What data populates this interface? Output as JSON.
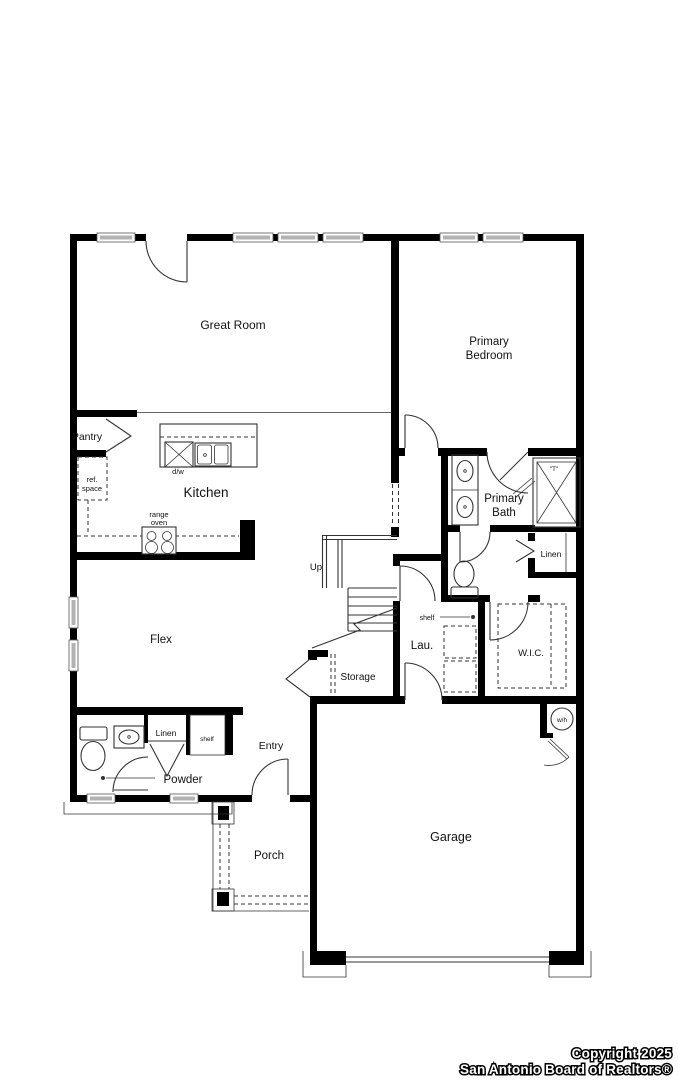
{
  "labels": {
    "great_room": "Great Room",
    "primary_bedroom_line1": "Primary",
    "primary_bedroom_line2": "Bedroom",
    "pantry": "Pantry",
    "ref_space_line1": "ref.",
    "ref_space_line2": "space",
    "kitchen": "Kitchen",
    "dishwasher": "d/w",
    "range_line1": "range",
    "range_line2": "oven",
    "primary_bath_line1": "Primary",
    "primary_bath_line2": "Bath",
    "shower_symbol": "\"T\"",
    "linen_bath": "Linen",
    "up": "Up",
    "flex": "Flex",
    "shelf_laundry": "shelf",
    "laundry": "Lau.",
    "wic": "W.I.C.",
    "storage": "Storage",
    "linen_hall": "Linen",
    "shelf_hall": "shelf",
    "entry": "Entry",
    "powder": "Powder",
    "water_heater": "w/h",
    "porch": "Porch",
    "garage": "Garage"
  },
  "copyright": {
    "line1": "Copyright 2025",
    "line2": "San Antonio Board of Realtors®"
  },
  "colors": {
    "wall": "#000000",
    "line": "#333333",
    "window": "#b3b3b3",
    "text": "#111111",
    "copyright_text": "#ffffff"
  }
}
